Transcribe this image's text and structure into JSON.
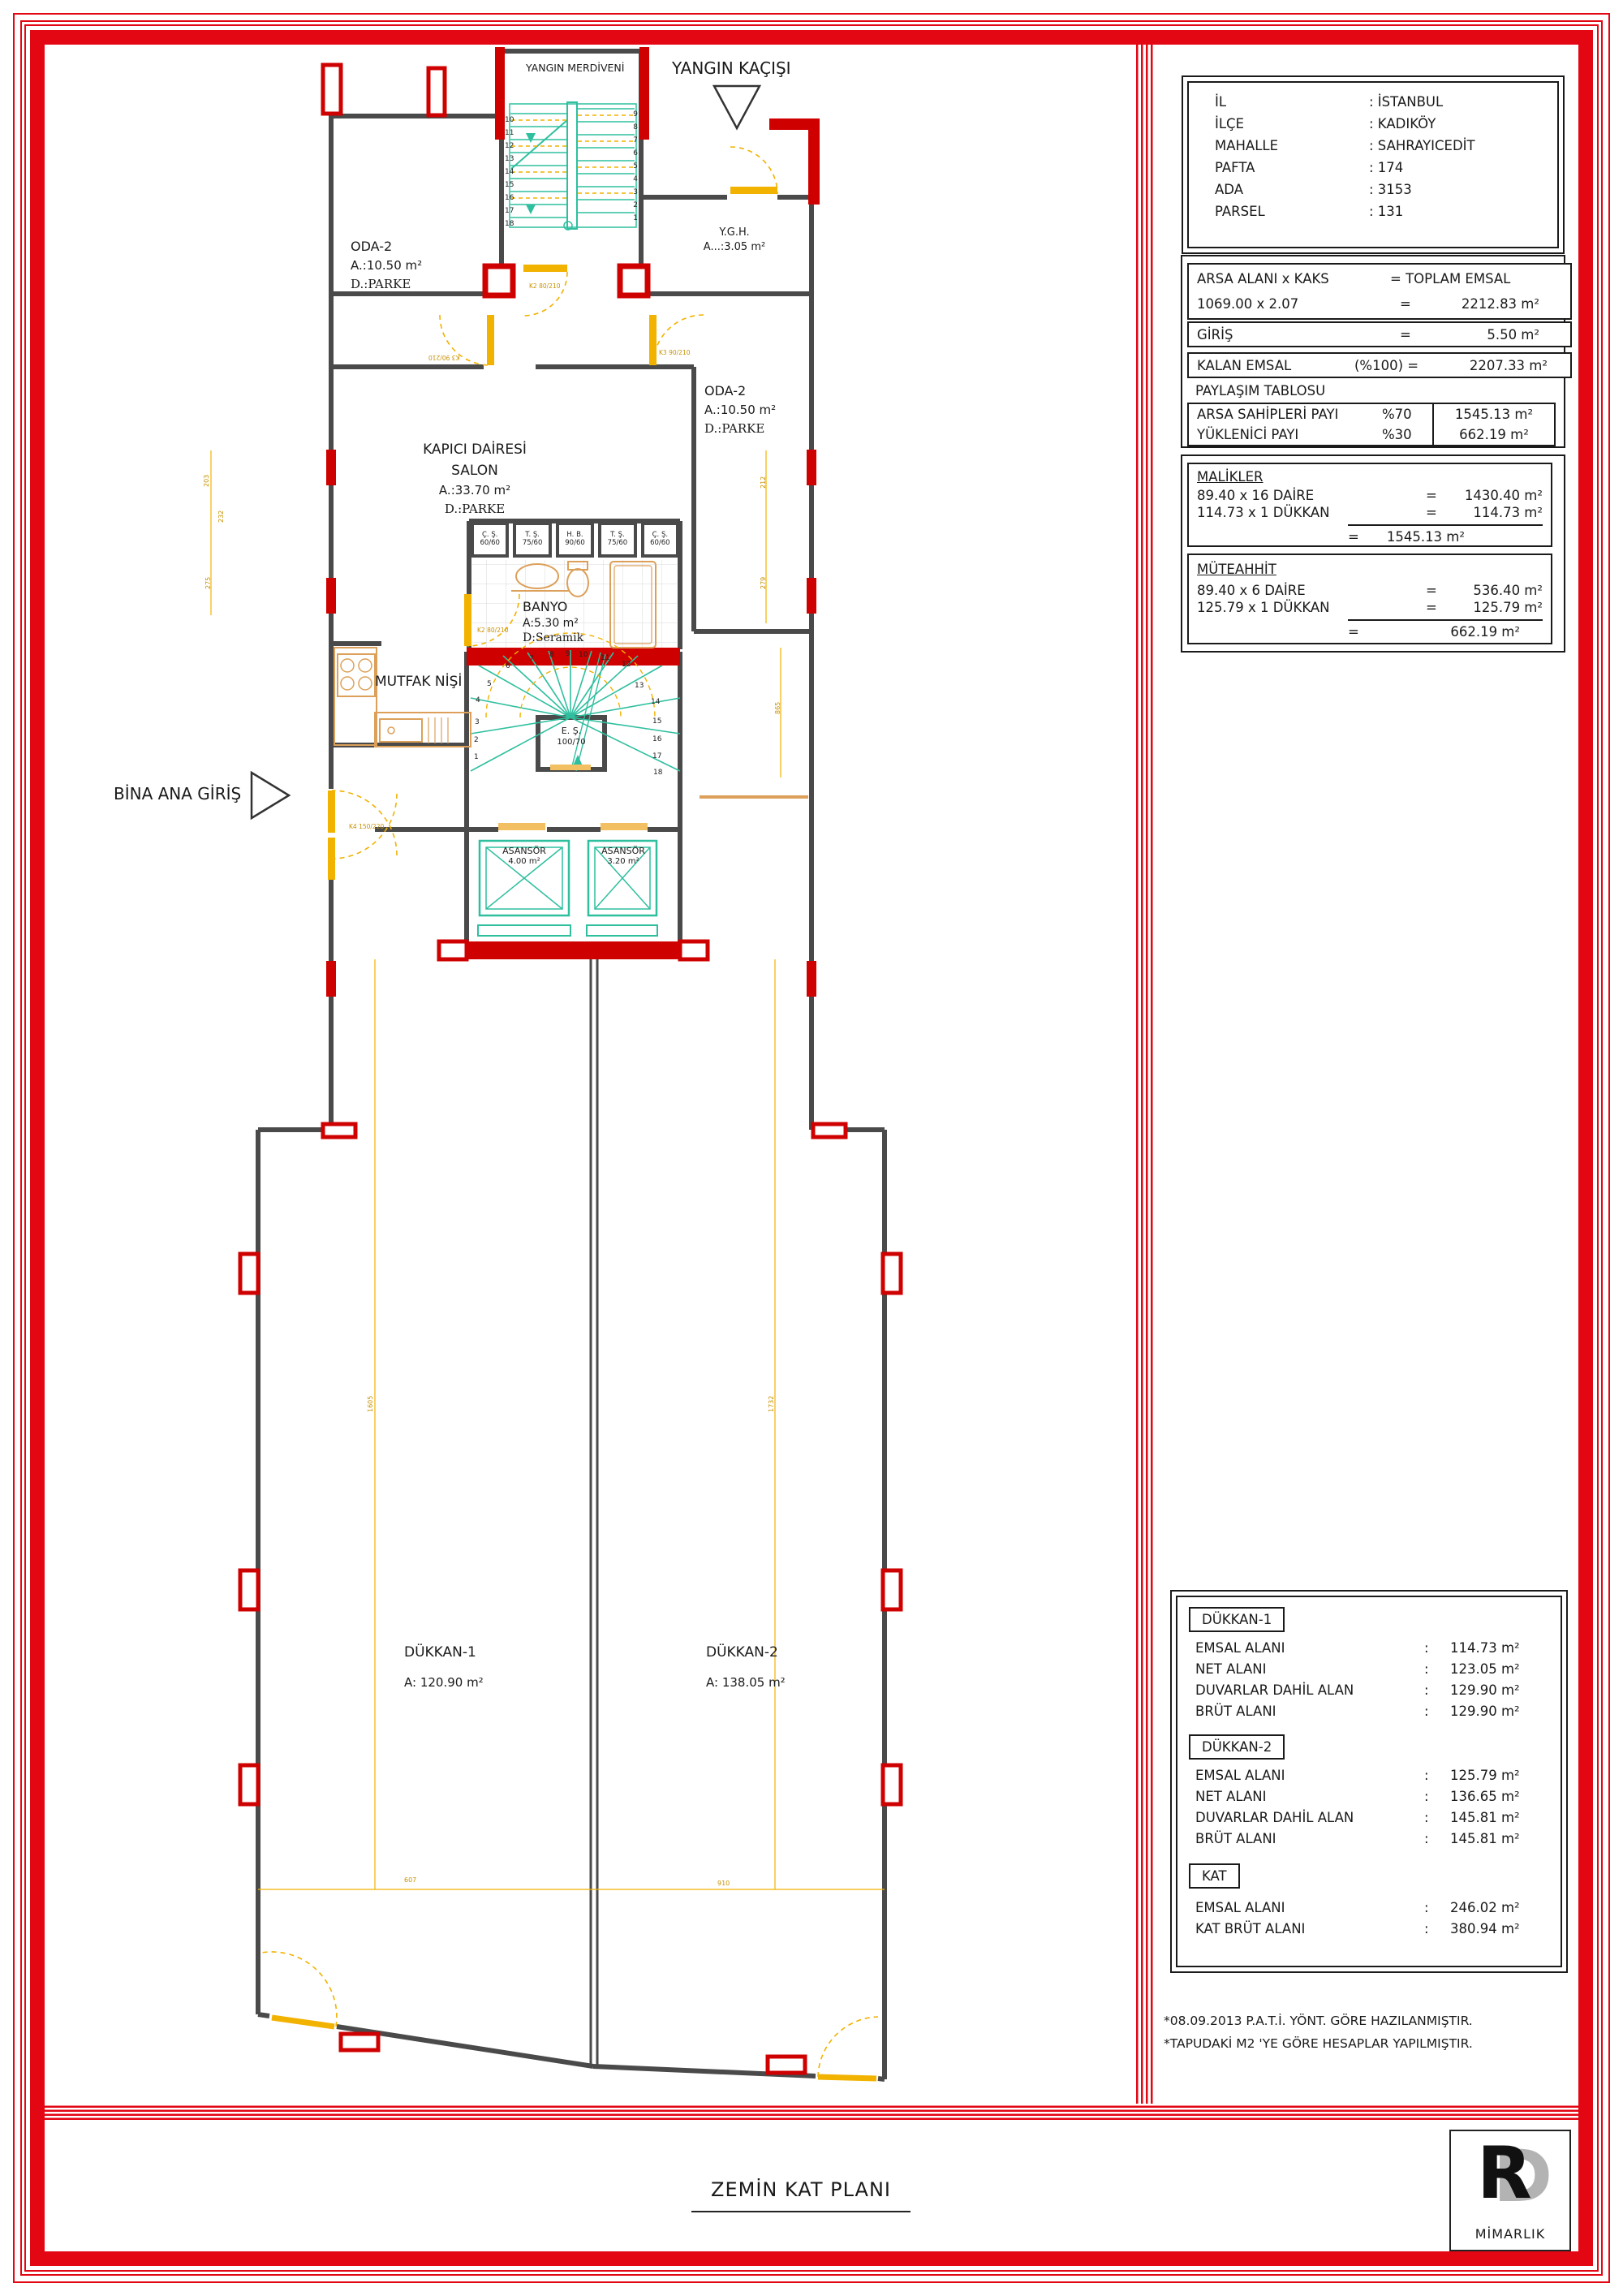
{
  "page": {
    "title": "ZEMİN KAT PLANI"
  },
  "logo": {
    "r": "R",
    "d": "D",
    "text": "MİMARLIK"
  },
  "parcel": {
    "rows": [
      {
        "label": "İL",
        "value": ": İSTANBUL"
      },
      {
        "label": "İLÇE",
        "value": ": KADIKÖY"
      },
      {
        "label": "MAHALLE",
        "value": ": SAHRAYICEDİT"
      },
      {
        "label": "PAFTA",
        "value": ": 174"
      },
      {
        "label": "ADA",
        "value": ": 3153"
      },
      {
        "label": "PARSEL",
        "value": ": 131"
      }
    ]
  },
  "emsal": {
    "h_left": "ARSA ALANI x KAKS",
    "h_right": "= TOPLAM EMSAL",
    "c_left": "1069.00 x 2.07",
    "c_eq": "=",
    "c_val": "2212.83 m²",
    "g_label": "GİRİŞ",
    "g_eq": "=",
    "g_val": "5.50 m²",
    "k_label": "KALAN EMSAL",
    "k_mid": "(%100) =",
    "k_val": "2207.33 m²",
    "p_title": "PAYLAŞIM TABLOSU",
    "p_rows": [
      {
        "label": "ARSA SAHİPLERİ PAYI",
        "pct": "%70",
        "val": "1545.13 m²"
      },
      {
        "label": "YÜKLENİCİ PAYI",
        "pct": "%30",
        "val": "662.19 m²"
      }
    ]
  },
  "malikler": {
    "title": "MALİKLER",
    "rows": [
      {
        "expr": "89.40 x 16 DAİRE",
        "eq": "=",
        "val": "1430.40 m²"
      },
      {
        "expr": "114.73 x 1 DÜKKAN",
        "eq": "=",
        "val": "114.73 m²"
      }
    ],
    "t_eq": "=",
    "t_val": "1545.13 m²"
  },
  "muteahhit": {
    "title": "MÜTEAHHİT",
    "rows": [
      {
        "expr": "89.40 x 6 DAİRE",
        "eq": "=",
        "val": "536.40 m²"
      },
      {
        "expr": "125.79 x 1 DÜKKAN",
        "eq": "=",
        "val": "125.79 m²"
      }
    ],
    "t_eq": "=",
    "t_val": "662.19 m²"
  },
  "shops": {
    "d1": {
      "title": "DÜKKAN-1",
      "rows": [
        {
          "label": "EMSAL ALANI",
          "sep": ":",
          "val": "114.73 m²"
        },
        {
          "label": "NET ALANI",
          "sep": ":",
          "val": "123.05 m²"
        },
        {
          "label": "DUVARLAR DAHİL ALAN",
          "sep": ":",
          "val": "129.90 m²"
        },
        {
          "label": "BRÜT ALANI",
          "sep": ":",
          "val": "129.90 m²"
        }
      ]
    },
    "d2": {
      "title": "DÜKKAN-2",
      "rows": [
        {
          "label": "EMSAL ALANI",
          "sep": ":",
          "val": "125.79 m²"
        },
        {
          "label": "NET ALANI",
          "sep": ":",
          "val": "136.65 m²"
        },
        {
          "label": "DUVARLAR DAHİL ALAN",
          "sep": ":",
          "val": "145.81 m²"
        },
        {
          "label": "BRÜT ALANI",
          "sep": ":",
          "val": "145.81 m²"
        }
      ]
    },
    "kat": {
      "title": "KAT",
      "rows": [
        {
          "label": "EMSAL ALANI",
          "sep": ":",
          "val": "246.02 m²"
        },
        {
          "label": "KAT BRÜT ALANI",
          "sep": ":",
          "val": "380.94 m²"
        }
      ]
    }
  },
  "notes": [
    "*08.09.2013 P.A.T.İ. YÖNT. GÖRE HAZILANMIŞTIR.",
    "*TAPUDAKİ M2 'YE GÖRE HESAPLAR YAPILMIŞTIR."
  ],
  "plan": {
    "yangin_merdiveni": "YANGIN MERDİVENİ",
    "yangin_kacisi": "YANGIN KAÇIŞI",
    "ygh1": "Y.G.H.",
    "ygh2": "A...:3.05 m²",
    "oda1": "ODA-2",
    "oda1a": "A.:10.50 m²",
    "oda1d": "D.:PARKE",
    "oda2": "ODA-2",
    "oda2a": "A.:10.50 m²",
    "oda2d": "D.:PARKE",
    "kap1": "KAPICI DAİRESİ",
    "kap2": "SALON",
    "kap3": "A.:33.70 m²",
    "kap4": "D.:PARKE",
    "cabinets": [
      {
        "l1": "Ç. Ş.",
        "l2": "60/60"
      },
      {
        "l1": "T. Ş.",
        "l2": "75/60"
      },
      {
        "l1": "H. B.",
        "l2": "90/60"
      },
      {
        "l1": "T. Ş.",
        "l2": "75/60"
      },
      {
        "l1": "Ç. Ş.",
        "l2": "60/60"
      }
    ],
    "banyo1": "BANYO",
    "banyo2": "A:5.30 m²",
    "banyo3": "D:Seramik",
    "mutfak": "MUTFAK NİŞİ",
    "es1": "E. Ş.",
    "es2": "100/70",
    "bina": "BİNA ANA GİRİŞ",
    "asansor1a": "ASANSÖR",
    "asansor1b": "4.00 m²",
    "asansor2a": "ASANSÖR",
    "asansor2b": "3.20 m²",
    "shop1a": "DÜKKAN-1",
    "shop1b": "A: 120.90 m²",
    "shop2a": "DÜKKAN-2",
    "shop2b": "A: 138.05 m²",
    "stair_left": [
      "10",
      "11",
      "12",
      "13",
      "14",
      "15",
      "16",
      "17",
      "18"
    ],
    "stair_right": [
      "9",
      "8",
      "7",
      "6",
      "5",
      "4",
      "3",
      "2",
      "1"
    ],
    "fan": [
      "1",
      "2",
      "3",
      "4",
      "5",
      "6",
      "7",
      "8",
      "9",
      "10",
      "11",
      "12",
      "13",
      "14",
      "15",
      "16",
      "17",
      "18"
    ],
    "doors": [
      "K2 80/210",
      "K3 90/210",
      "K3 90/210",
      "K2 80/210",
      "K4 150/220"
    ],
    "dims": [
      "203",
      "232",
      "275",
      "212",
      "279",
      "865",
      "1605",
      "1732",
      "607",
      "910"
    ]
  }
}
